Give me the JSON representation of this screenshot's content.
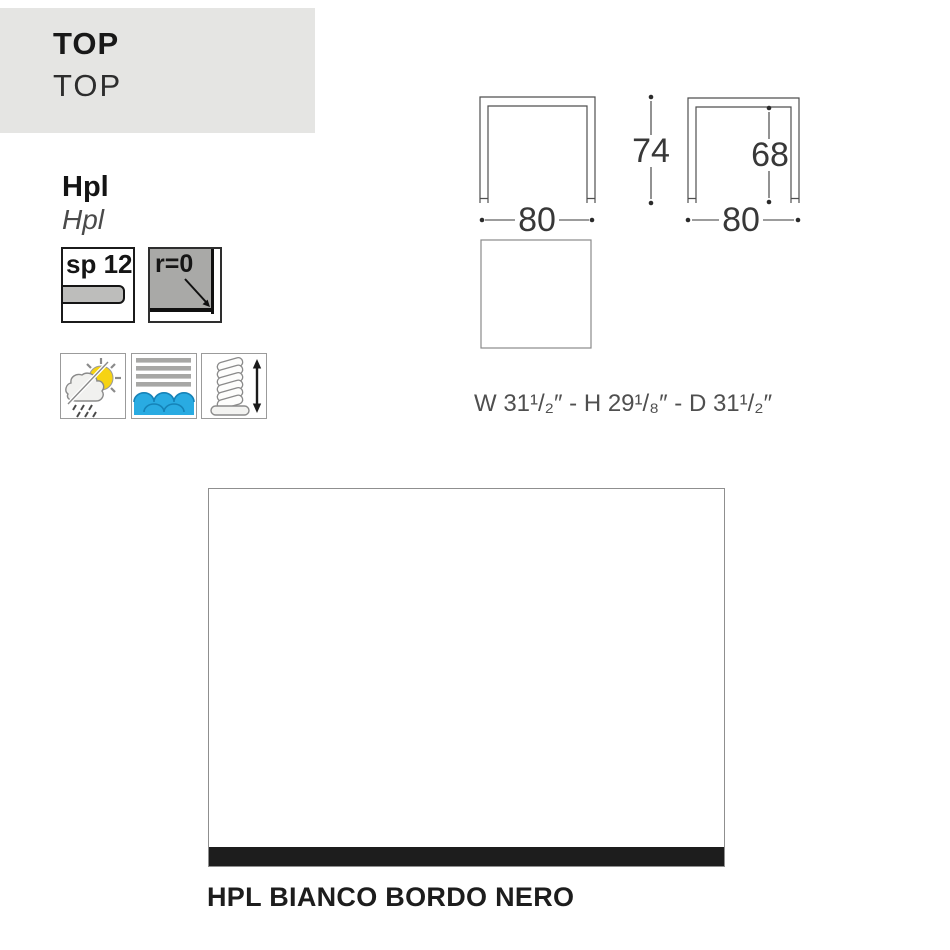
{
  "header": {
    "title": "TOP",
    "subtitle": "TOP",
    "bg_color": "#e5e5e3"
  },
  "material": {
    "name": "Hpl",
    "name_alt": "Hpl"
  },
  "specs": {
    "thickness_label": "sp 12",
    "radius_label": "r=0"
  },
  "feature_icons": [
    {
      "name": "weather-resistant-icon"
    },
    {
      "name": "water-resistant-icon"
    },
    {
      "name": "adjustable-feet-icon"
    }
  ],
  "drawings": {
    "front_view": {
      "width_cm": "80",
      "height_cm": "74"
    },
    "side_view": {
      "width_cm": "80",
      "inner_height_cm": "68"
    },
    "imperial_dimensions": "W 31¹/₂″ - H 29¹/₈″ - D 31¹/₂″"
  },
  "finish": {
    "caption": "HPL BIANCO BORDO NERO",
    "top_color": "#ffffff",
    "edge_color": "#1d1d1d"
  },
  "colors": {
    "water_blue": "#29abe2",
    "water_blue_dark": "#1583b8",
    "sun_yellow": "#f6d313",
    "icon_gray": "#a7a7a5",
    "line_gray": "#4f4f4f"
  }
}
